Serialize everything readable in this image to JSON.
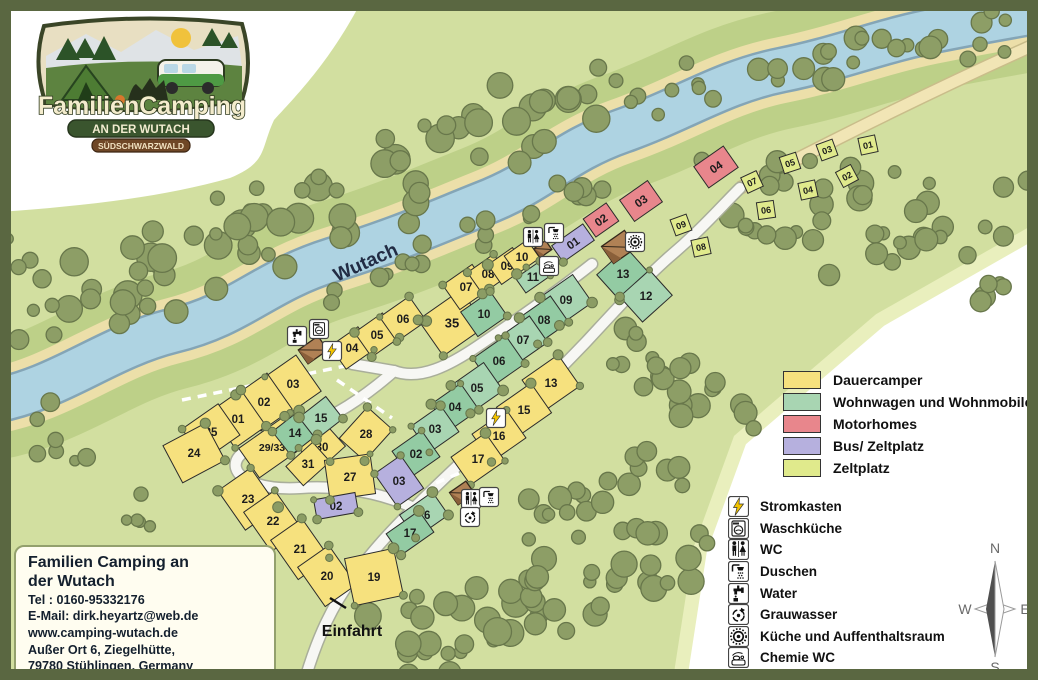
{
  "logo": {
    "title": "FamilienCamping",
    "subtitle": "AN DER WUTACH",
    "badge": "SÜDSCHWARZWALD"
  },
  "contact": {
    "title1": "Familien Camping an",
    "title2": "der Wutach",
    "tel": "Tel : 0160-95332176",
    "email": "E-Mail: dirk.heyartz@web.de",
    "web": "www.camping-wutach.de",
    "addr1": "Außer Ort 6, Ziegelhütte,",
    "addr2": "79780 Stühlingen, Germany"
  },
  "map_labels": {
    "river": "Wutach",
    "entrance": "Einfahrt"
  },
  "compass": {
    "n": "N",
    "e": "E",
    "s": "S",
    "w": "W"
  },
  "colors": {
    "dauer": "#f6e17e",
    "wohn": "#a8d5b2",
    "motor": "#e8868c",
    "bus": "#b6b0de",
    "zelt": "#e0ea8c"
  },
  "legend_types": [
    {
      "key": "dauer",
      "label": "Dauercamper"
    },
    {
      "key": "wohn",
      "label": "Wohnwagen und Wohnmobile"
    },
    {
      "key": "motor",
      "label": "Motorhomes"
    },
    {
      "key": "bus",
      "label": "Bus/ Zeltplatz"
    },
    {
      "key": "zelt",
      "label": "Zeltplatz"
    }
  ],
  "legend_facilities": [
    {
      "icon": "lightning",
      "label": "Stromkasten"
    },
    {
      "icon": "washer",
      "label": "Waschküche"
    },
    {
      "icon": "wc",
      "label": "WC"
    },
    {
      "icon": "shower",
      "label": "Duschen"
    },
    {
      "icon": "tap",
      "label": "Water"
    },
    {
      "icon": "recycle",
      "label": "Grauwasser"
    },
    {
      "icon": "kitchen",
      "label": "Küche und Auffenthaltsraum"
    },
    {
      "icon": "chem",
      "label": "Chemie WC"
    }
  ],
  "plots": [
    {
      "n": "04",
      "t": "dauer",
      "x": 352,
      "y": 348,
      "w": 34,
      "h": 28,
      "r": -35
    },
    {
      "n": "05",
      "t": "dauer",
      "x": 377,
      "y": 335,
      "w": 34,
      "h": 30,
      "r": -35
    },
    {
      "n": "06",
      "t": "dauer",
      "x": 403,
      "y": 319,
      "w": 36,
      "h": 30,
      "r": -35
    },
    {
      "n": "35",
      "t": "dauer",
      "x": 452,
      "y": 323,
      "w": 52,
      "h": 44,
      "r": -35,
      "fs": 13
    },
    {
      "n": "07",
      "t": "dauer",
      "x": 466,
      "y": 287,
      "w": 36,
      "h": 30,
      "r": -35
    },
    {
      "n": "08",
      "t": "dauer",
      "x": 488,
      "y": 274,
      "w": 32,
      "h": 26,
      "r": -35
    },
    {
      "n": "09",
      "t": "dauer",
      "x": 507,
      "y": 266,
      "w": 30,
      "h": 24,
      "r": -35
    },
    {
      "n": "10",
      "t": "dauer",
      "x": 522,
      "y": 257,
      "w": 28,
      "h": 22,
      "r": -35
    },
    {
      "n": "03",
      "t": "dauer",
      "x": 293,
      "y": 384,
      "w": 38,
      "h": 44,
      "r": -35
    },
    {
      "n": "02",
      "t": "dauer",
      "x": 264,
      "y": 402,
      "w": 38,
      "h": 44,
      "r": -35
    },
    {
      "n": "01",
      "t": "dauer",
      "x": 238,
      "y": 419,
      "w": 38,
      "h": 44,
      "r": -35
    },
    {
      "n": "25",
      "t": "dauer",
      "x": 211,
      "y": 432,
      "w": 44,
      "h": 38,
      "r": -35
    },
    {
      "n": "24",
      "t": "dauer",
      "x": 194,
      "y": 453,
      "w": 48,
      "h": 42,
      "r": -28
    },
    {
      "n": "23",
      "t": "dauer",
      "x": 248,
      "y": 499,
      "w": 40,
      "h": 48,
      "r": -35
    },
    {
      "n": "22",
      "t": "dauer",
      "x": 273,
      "y": 521,
      "w": 38,
      "h": 48,
      "r": -35
    },
    {
      "n": "21",
      "t": "dauer",
      "x": 300,
      "y": 549,
      "w": 38,
      "h": 48,
      "r": -35
    },
    {
      "n": "20",
      "t": "dauer",
      "x": 327,
      "y": 576,
      "w": 38,
      "h": 48,
      "r": -35
    },
    {
      "n": "19",
      "t": "dauer",
      "x": 374,
      "y": 577,
      "w": 50,
      "h": 48,
      "r": -12
    },
    {
      "n": "29/33",
      "t": "dauer",
      "x": 272,
      "y": 447,
      "w": 56,
      "h": 36,
      "r": -35,
      "fs": 10.5
    },
    {
      "n": "30",
      "t": "dauer",
      "x": 322,
      "y": 447,
      "w": 36,
      "h": 30,
      "r": -42
    },
    {
      "n": "31",
      "t": "dauer",
      "x": 308,
      "y": 464,
      "w": 36,
      "h": 26,
      "r": -42
    },
    {
      "n": "28",
      "t": "dauer",
      "x": 366,
      "y": 434,
      "w": 42,
      "h": 34,
      "r": -48
    },
    {
      "n": "27",
      "t": "dauer",
      "x": 350,
      "y": 477,
      "w": 46,
      "h": 40,
      "r": -8
    },
    {
      "n": "13",
      "t": "dauer",
      "x": 551,
      "y": 383,
      "w": 44,
      "h": 38,
      "r": -35
    },
    {
      "n": "15",
      "t": "dauer",
      "x": 524,
      "y": 410,
      "w": 42,
      "h": 36,
      "r": -35
    },
    {
      "n": "16",
      "t": "dauer",
      "x": 499,
      "y": 436,
      "w": 42,
      "h": 34,
      "r": -35
    },
    {
      "n": "17",
      "t": "dauer",
      "x": 478,
      "y": 459,
      "w": 42,
      "h": 34,
      "r": -35
    },
    {
      "n": "14",
      "t": "wohn",
      "x": 295,
      "y": 433,
      "w": 34,
      "h": 30,
      "r": -38
    },
    {
      "n": "15",
      "t": "wohn",
      "x": 321,
      "y": 418,
      "w": 34,
      "h": 28,
      "r": -38
    },
    {
      "n": "10",
      "t": "wohn",
      "x": 484,
      "y": 314,
      "w": 36,
      "h": 30,
      "r": -35
    },
    {
      "n": "09",
      "t": "wohn",
      "x": 566,
      "y": 300,
      "w": 40,
      "h": 34,
      "r": -35
    },
    {
      "n": "08",
      "t": "wohn",
      "x": 544,
      "y": 320,
      "w": 38,
      "h": 32,
      "r": -35
    },
    {
      "n": "07",
      "t": "wohn",
      "x": 523,
      "y": 340,
      "w": 38,
      "h": 32,
      "r": -35
    },
    {
      "n": "06",
      "t": "wohn",
      "x": 499,
      "y": 361,
      "w": 40,
      "h": 34,
      "r": -35
    },
    {
      "n": "05",
      "t": "wohn",
      "x": 477,
      "y": 388,
      "w": 40,
      "h": 34,
      "r": -35
    },
    {
      "n": "04",
      "t": "wohn",
      "x": 455,
      "y": 407,
      "w": 36,
      "h": 32,
      "r": -35
    },
    {
      "n": "03",
      "t": "wohn",
      "x": 435,
      "y": 429,
      "w": 36,
      "h": 32,
      "r": -35
    },
    {
      "n": "02",
      "t": "wohn",
      "x": 416,
      "y": 454,
      "w": 36,
      "h": 32,
      "r": -35
    },
    {
      "n": "16",
      "t": "wohn",
      "x": 424,
      "y": 515,
      "w": 40,
      "h": 28,
      "r": -35
    },
    {
      "n": "17",
      "t": "wohn",
      "x": 410,
      "y": 533,
      "w": 40,
      "h": 26,
      "r": -35
    },
    {
      "n": "11",
      "t": "wohn",
      "x": 533,
      "y": 277,
      "w": 30,
      "h": 18,
      "r": -35
    },
    {
      "n": "13",
      "t": "wohn",
      "x": 623,
      "y": 274,
      "w": 40,
      "h": 34,
      "r": -42
    },
    {
      "n": "12",
      "t": "wohn",
      "x": 646,
      "y": 296,
      "w": 40,
      "h": 34,
      "r": -42
    },
    {
      "n": "02",
      "t": "motor",
      "x": 601,
      "y": 220,
      "w": 28,
      "h": 22,
      "r": -35,
      "lr": 1
    },
    {
      "n": "03",
      "t": "motor",
      "x": 641,
      "y": 201,
      "w": 34,
      "h": 26,
      "r": -35,
      "lr": 1
    },
    {
      "n": "04",
      "t": "motor",
      "x": 716,
      "y": 167,
      "w": 36,
      "h": 26,
      "r": -35,
      "lr": 1
    },
    {
      "n": "01",
      "t": "bus",
      "x": 573,
      "y": 243,
      "w": 38,
      "h": 20,
      "r": -35,
      "lr": 1
    },
    {
      "n": "02",
      "t": "bus",
      "x": 336,
      "y": 506,
      "w": 42,
      "h": 20,
      "r": -10
    },
    {
      "n": "03",
      "t": "bus",
      "x": 399,
      "y": 481,
      "w": 32,
      "h": 40,
      "r": -35
    },
    {
      "n": "09",
      "t": "zelt",
      "x": 681,
      "y": 225,
      "w": 17,
      "h": 17,
      "r": -20,
      "lr": 1,
      "fs": 9
    },
    {
      "n": "08",
      "t": "zelt",
      "x": 701,
      "y": 247,
      "w": 17,
      "h": 17,
      "r": -12,
      "lr": 1,
      "fs": 9
    },
    {
      "n": "07",
      "t": "zelt",
      "x": 752,
      "y": 182,
      "w": 17,
      "h": 17,
      "r": -25,
      "lr": 1,
      "fs": 9
    },
    {
      "n": "06",
      "t": "zelt",
      "x": 766,
      "y": 210,
      "w": 17,
      "h": 17,
      "r": -8,
      "lr": 1,
      "fs": 9
    },
    {
      "n": "05",
      "t": "zelt",
      "x": 790,
      "y": 163,
      "w": 17,
      "h": 17,
      "r": -18,
      "lr": 1,
      "fs": 9
    },
    {
      "n": "04",
      "t": "zelt",
      "x": 808,
      "y": 190,
      "w": 17,
      "h": 17,
      "r": -12,
      "lr": 1,
      "fs": 9
    },
    {
      "n": "03",
      "t": "zelt",
      "x": 827,
      "y": 150,
      "w": 17,
      "h": 17,
      "r": -20,
      "lr": 1,
      "fs": 9
    },
    {
      "n": "02",
      "t": "zelt",
      "x": 847,
      "y": 176,
      "w": 17,
      "h": 17,
      "r": -28,
      "lr": 1,
      "fs": 9
    },
    {
      "n": "01",
      "t": "zelt",
      "x": 868,
      "y": 145,
      "w": 17,
      "h": 17,
      "r": -12,
      "lr": 1,
      "fs": 9
    }
  ],
  "facility_markers": [
    {
      "t": "tap",
      "x": 297,
      "y": 336
    },
    {
      "t": "washer",
      "x": 319,
      "y": 329
    },
    {
      "t": "lightning",
      "x": 332,
      "y": 351
    },
    {
      "t": "wc",
      "x": 533,
      "y": 237
    },
    {
      "t": "shower",
      "x": 554,
      "y": 233
    },
    {
      "t": "chem",
      "x": 549,
      "y": 266
    },
    {
      "t": "kitchen",
      "x": 635,
      "y": 242
    },
    {
      "t": "lightning",
      "x": 496,
      "y": 418
    },
    {
      "t": "wc",
      "x": 471,
      "y": 499
    },
    {
      "t": "shower",
      "x": 489,
      "y": 497
    },
    {
      "t": "recycle",
      "x": 470,
      "y": 517
    }
  ],
  "huts": [
    {
      "x": 313,
      "y": 350,
      "w": 24,
      "h": 17,
      "r": -35
    },
    {
      "x": 543,
      "y": 249,
      "w": 14,
      "h": 11,
      "r": -35
    },
    {
      "x": 619,
      "y": 247,
      "w": 28,
      "h": 21,
      "r": -35
    },
    {
      "x": 462,
      "y": 493,
      "w": 20,
      "h": 15,
      "r": -35
    }
  ]
}
